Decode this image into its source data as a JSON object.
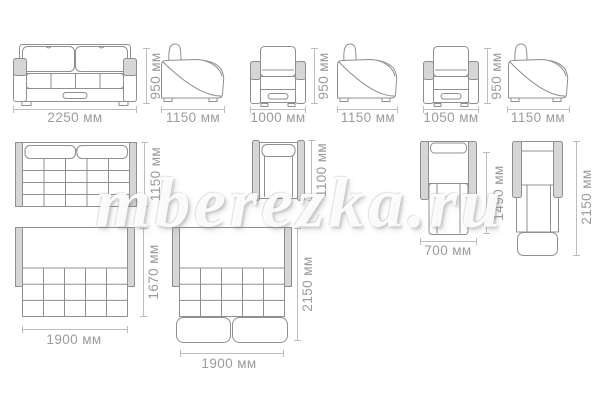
{
  "watermark": {
    "text": "mberezka.ru"
  },
  "units": "мм",
  "colors": {
    "background": "#ffffff",
    "outline": "#8f8f8f",
    "armrest_fill": "#d6d6d6",
    "dimension_line": "#bdbdbd",
    "dimension_text": "#9b9b9b",
    "watermark_fill": "#ffffff"
  },
  "views": {
    "sofa_front": {
      "width": "2250 мм",
      "height": "950 мм"
    },
    "sofa_side": {
      "depth": "1150 мм"
    },
    "armchair1_front": {
      "width": "1000 мм",
      "height": "950 мм"
    },
    "armchair1_side": {
      "depth": "1150 мм"
    },
    "armchair2_front": {
      "width": "1050 мм",
      "height": "950 мм"
    },
    "armchair2_side": {
      "depth": "1150 мм"
    },
    "sofa_top": {
      "depth": "1150 мм"
    },
    "armchair_top": {
      "depth": "1100 мм"
    },
    "armchair_bed_top": {
      "width": "700 мм",
      "bed_length": "1490 мм"
    },
    "armchair_bed_full": {
      "length": "2150 мм"
    },
    "sofa_bed_top": {
      "width": "1900 мм",
      "depth": "1670 мм"
    },
    "sofa_bed_full": {
      "width": "1900 мм",
      "length": "2150 мм"
    }
  }
}
